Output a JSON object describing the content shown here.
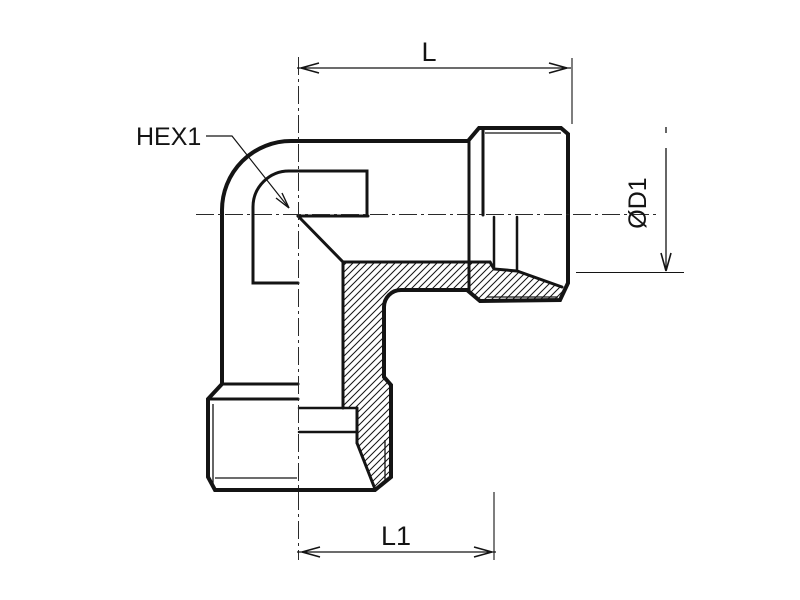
{
  "drawing": {
    "kind": "technical-drawing",
    "subject": "90-degree elbow fitting, half-section view",
    "labels": {
      "dim_length_top": "L",
      "hex": "HEX1",
      "diameter": "ØD1",
      "dim_length_bottom": "L1"
    },
    "colors": {
      "line": "#141414",
      "background": "#ffffff"
    }
  }
}
